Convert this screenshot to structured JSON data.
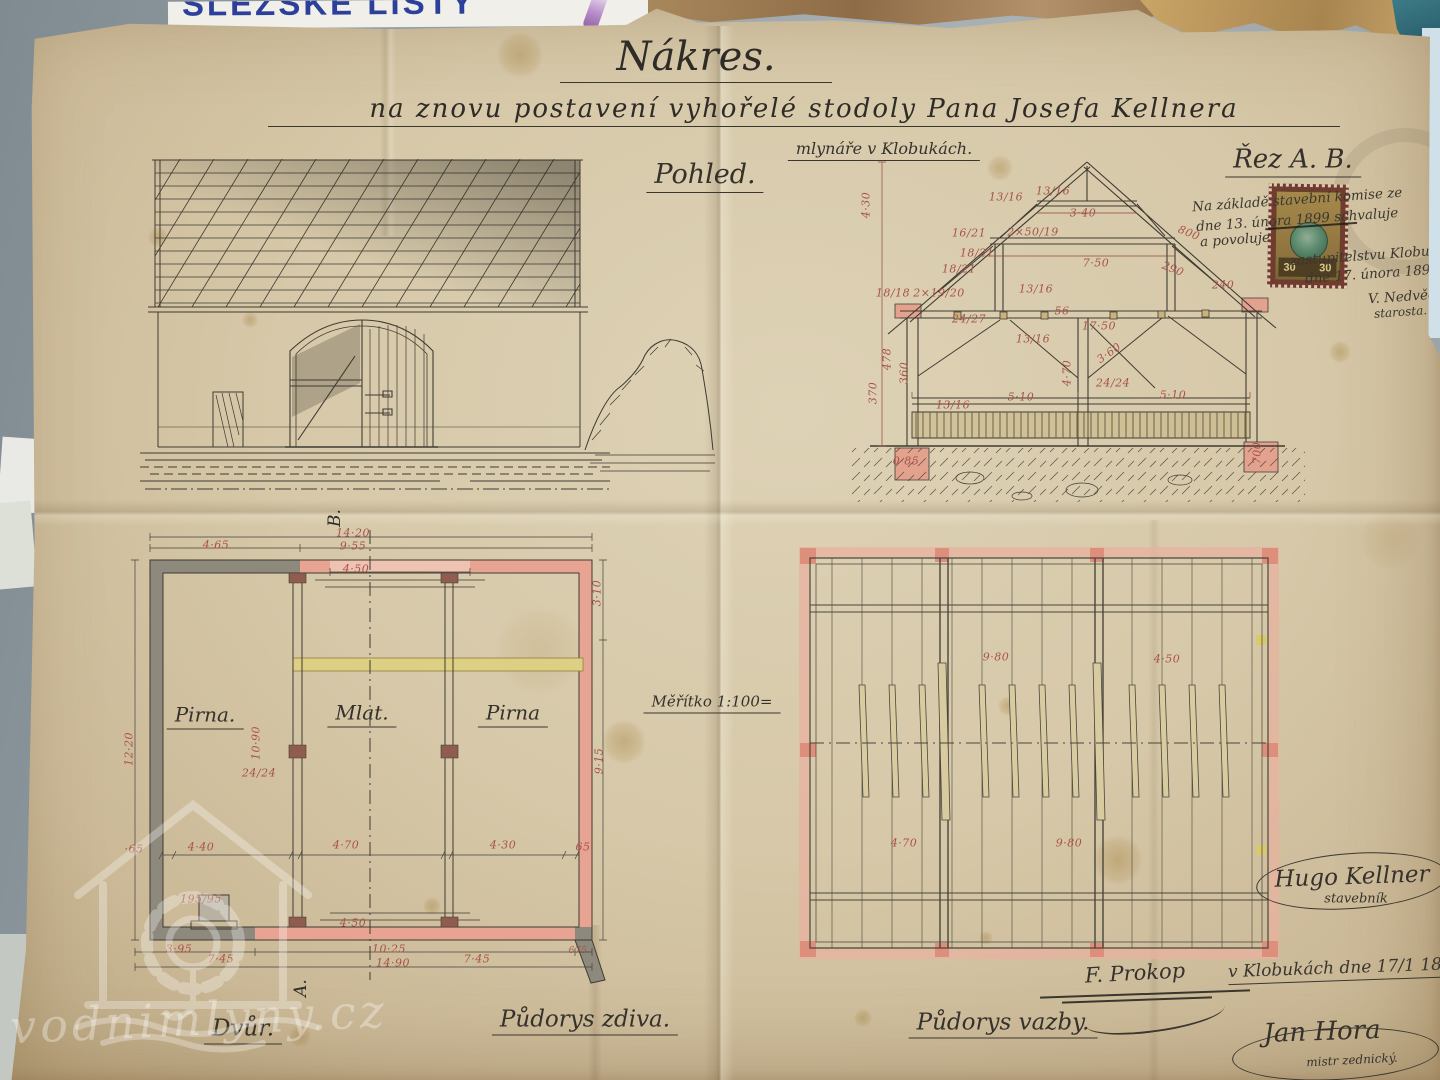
{
  "titles": {
    "main": "Nákres.",
    "subtitle": "na znovu postavení vyhořelé stodoly Pana Josefa Kellnera",
    "subtitle2": "mlynáře v Klobukách.",
    "elevation_label": "Pohled.",
    "section_label": "Řez A. B.",
    "scale": "Měřítko 1:100=",
    "floorplan_label": "Půdorys zdiva.",
    "framing_label": "Půdorys vazby.",
    "yard": "Dvůr.",
    "marker_a": "A.",
    "marker_b": "B."
  },
  "rooms": [
    "Pirna.",
    "Mlat.",
    "Pirna"
  ],
  "dims": {
    "section": [
      "4·30",
      "13/16",
      "13/16",
      "3·40",
      "16/21",
      "2×50/19",
      "800",
      "18/21",
      "7·50",
      "290",
      "13/16",
      "240",
      "18/21",
      "2×19/20",
      "18/18",
      "24/27",
      "17·50",
      "56",
      "13/16",
      "3·60",
      "4·70",
      "24/24",
      "5·10",
      "5·10",
      "13/16",
      "478",
      "360",
      "370",
      "0·85",
      "700"
    ],
    "floorplan": [
      "14·20",
      "4·65",
      "9·55",
      "4·50",
      "3·10",
      "12·20",
      "10·90",
      "24/24",
      "9·15",
      "·65",
      "4·40",
      "4·70",
      "4·30",
      "65",
      "195/95",
      "4·50",
      "3·95",
      "7·45",
      "10·25",
      "14·90",
      "7·45",
      "675"
    ],
    "framing": [
      "9·80",
      "4·50",
      "4·70",
      "9·80"
    ]
  },
  "approval": {
    "lines": [
      "Na základě stavební komise ze",
      "dne 13. února 1899 schvaluje",
      "a povoluje",
      "zastupitelstvu Klobuk",
      "dne 17. února 1899.",
      "V. Nedvěd",
      "starosta."
    ],
    "stamp_value": "30"
  },
  "signatures": {
    "builder": "Hugo Kellner",
    "builder_title": "stavebník",
    "witness": "F. Prokop",
    "place_date": "v Klobukách dne 17/1 1899",
    "master": "Jan Hora",
    "master_title": "mistr zednický."
  },
  "watermark": "vodnimlyny.cz",
  "surroundings": {
    "newspaper": "SLEZSKÉ LISTY"
  },
  "colors": {
    "paper": "#d6c8a8",
    "ink": "#3f3b33",
    "dim_red": "#a8524a",
    "wall_grey": "#8d897d",
    "wall_pink": "#e7a492",
    "beam_yellow": "#ddcf83"
  }
}
